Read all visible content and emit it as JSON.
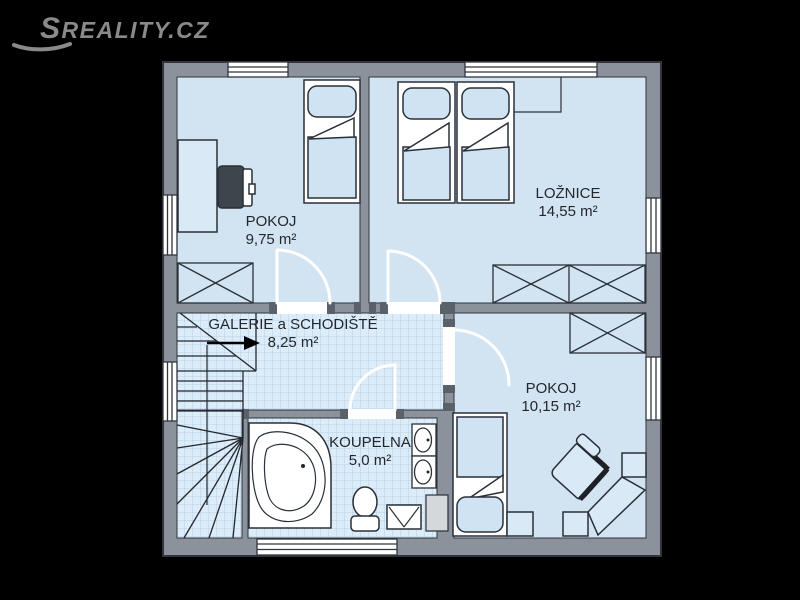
{
  "watermark": {
    "text": "SREALITY.CZ"
  },
  "rooms": {
    "pokoj1": {
      "name": "POKOJ",
      "area": "9,75 m²"
    },
    "loznice": {
      "name": "LOŽNICE",
      "area": "14,55 m²"
    },
    "galerie": {
      "name": "GALERIE a SCHODIŠTĚ",
      "area": "8,25 m²"
    },
    "koupelna": {
      "name": "KOUPELNA",
      "area": "5,0 m²"
    },
    "pokoj2": {
      "name": "POKOJ",
      "area": "10,15 m²"
    }
  },
  "icons": [
    "single-bed-icon",
    "double-bed-icon",
    "wardrobe-icon",
    "desk-icon",
    "office-chair-icon",
    "staircase-icon",
    "direction-arrow-icon",
    "door-swing-icon",
    "window-icon",
    "corner-bathtub-icon",
    "toilet-icon",
    "sink-icon",
    "washing-machine-icon",
    "armchair-icon",
    "corner-desk-icon",
    "nightstand-icon",
    "installation-shaft"
  ],
  "colors": {
    "background": "#000000",
    "wall": "#8b929b",
    "wall_stud": "#5a6169",
    "floor": "#d2e4f2",
    "tile": "#dcecf8",
    "tile_line": "#aecbe4",
    "furniture": "#d9e9f6",
    "outline": "#2a3038",
    "white": "#ffffff",
    "text": "#23272d",
    "logo": "#8a8a8a"
  }
}
